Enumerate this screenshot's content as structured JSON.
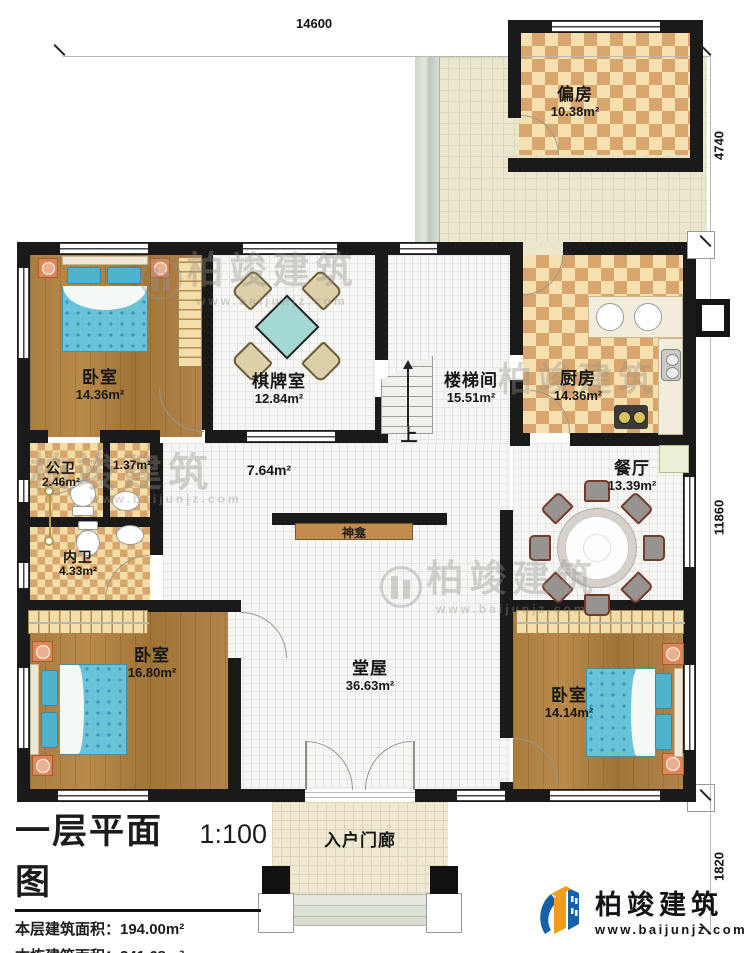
{
  "dimensions": {
    "top": "14600",
    "right_upper": "4740",
    "right_middle": "11860",
    "right_lower": "1820"
  },
  "rooms": {
    "pianfang": {
      "name": "偏房",
      "area": "10.38m²"
    },
    "bedroom_tl": {
      "name": "卧室",
      "area": "14.36m²"
    },
    "qipai": {
      "name": "棋牌室",
      "area": "12.84m²"
    },
    "louti": {
      "name": "楼梯间",
      "area": "15.51m²"
    },
    "kitchen": {
      "name": "厨房",
      "area": "14.36m²"
    },
    "gongwei": {
      "name": "公卫",
      "area": "2.46m²"
    },
    "vestibule": {
      "area": "1.37m²"
    },
    "neiwei": {
      "name": "内卫",
      "area": "4.33m²"
    },
    "corridor": {
      "area": "7.64m²"
    },
    "dining": {
      "name": "餐厅",
      "area": "13.39m²"
    },
    "shrine": {
      "name": "神龛"
    },
    "bedroom_bl": {
      "name": "卧室",
      "area": "16.80m²"
    },
    "hall": {
      "name": "堂屋",
      "area": "36.63m²"
    },
    "bedroom_br": {
      "name": "卧室",
      "area": "14.14m²"
    },
    "porch": {
      "name": "入户门廊"
    }
  },
  "stairs": {
    "up": "上"
  },
  "title_block": {
    "title": "一层平面图",
    "scale": "1:100",
    "line1": "本层建筑面积：194.00m²",
    "line2": "本栋建筑面积：341.68m²",
    "line3a": "占地面积：194.00m²",
    "line3b": "层高：3.6m"
  },
  "brand": {
    "name": "柏竣建筑",
    "url": "www.baijunjz.com"
  },
  "watermark": {
    "text": "柏竣建筑",
    "url": "www.baijunjz.com"
  }
}
